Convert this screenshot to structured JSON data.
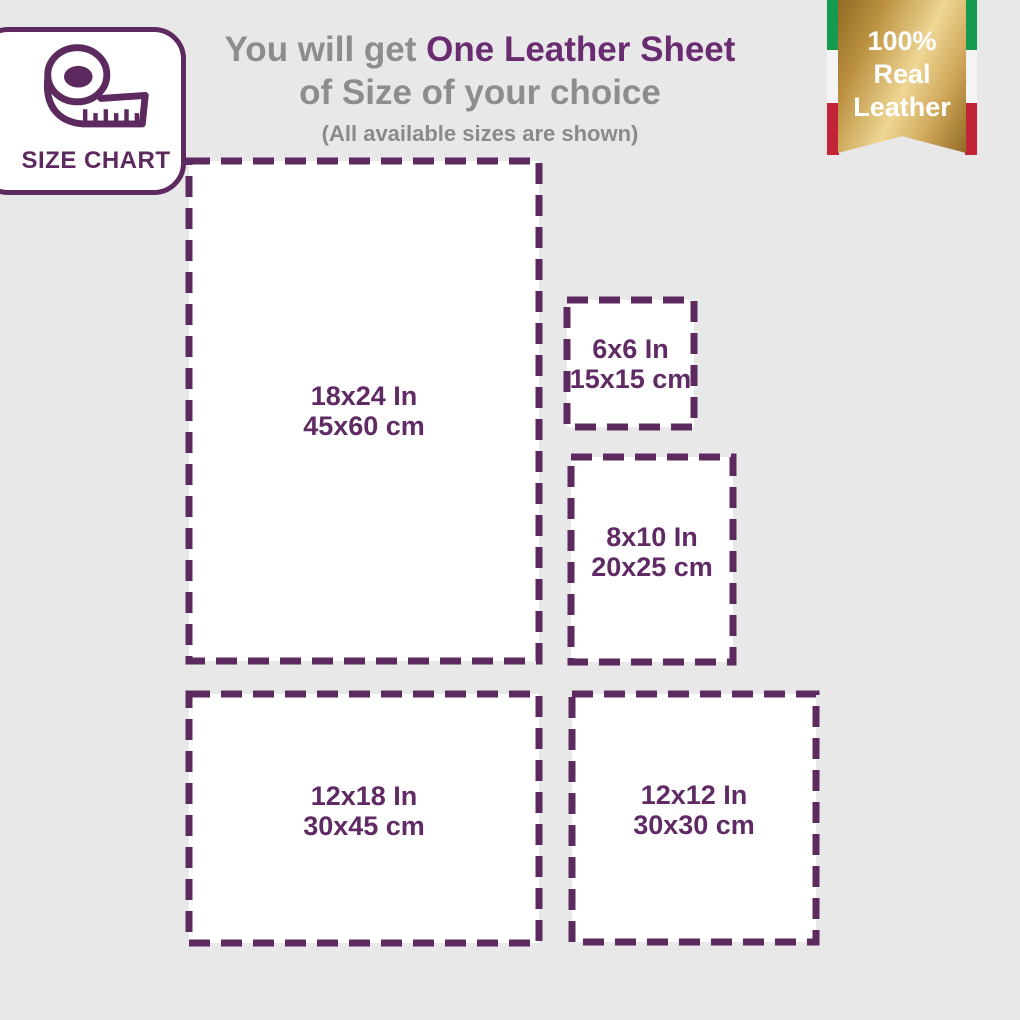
{
  "badge": {
    "label": "SIZE CHART",
    "icon": "measuring-tape-icon"
  },
  "title": {
    "gray_prefix": "You will get",
    "highlight": "One Leather Sheet",
    "line2": "of Size of your choice",
    "note": "(All available sizes are shown)"
  },
  "ribbon": {
    "line1": "100%",
    "line2": "Real",
    "line3": "Leather"
  },
  "sizes": [
    {
      "name": "18x24-in",
      "inches": "18x24 In",
      "cm": "45x60 cm"
    },
    {
      "name": "6x6-in",
      "inches": "6x6 In",
      "cm": "15x15 cm"
    },
    {
      "name": "8x10-in",
      "inches": "8x10 In",
      "cm": "20x25 cm"
    },
    {
      "name": "12x18-in",
      "inches": "12x18 In",
      "cm": "30x45 cm"
    },
    {
      "name": "12x12-in",
      "inches": "12x12 In",
      "cm": "30x30 cm"
    }
  ],
  "colors": {
    "background": "#e8e8e8",
    "box_fill": "#ffffff",
    "dash_purple": "#5c2a5e",
    "label_purple": "#602b64",
    "title_purple": "#6a2c70",
    "text_gray": "#8d8d8d",
    "gold_dark": "#8f6a24",
    "gold_light": "#eed694",
    "flag_green": "#169a4e",
    "flag_white": "#f4f4f4",
    "flag_red": "#c22337"
  }
}
